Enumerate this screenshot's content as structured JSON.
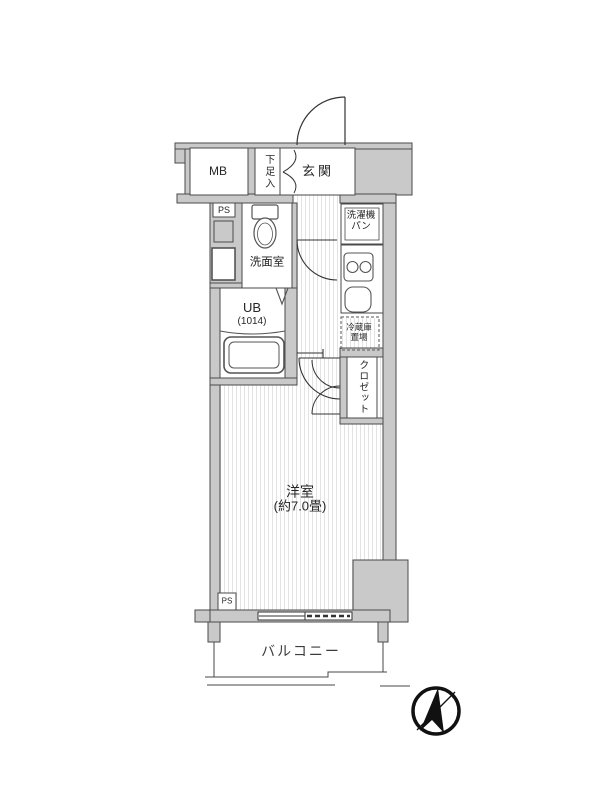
{
  "plan": {
    "type": "apartment-floor-plan",
    "rooms": {
      "meter_box": {
        "label": "MB"
      },
      "shoe_storage": {
        "label": "下足入"
      },
      "entrance": {
        "label": "玄関"
      },
      "pipe_space_upper": {
        "label": "PS"
      },
      "washroom": {
        "label": "洗面室"
      },
      "washing_machine_pan": {
        "line1": "洗濯機",
        "line2": "パン"
      },
      "unit_bath": {
        "label": "UB",
        "size": "(1014)"
      },
      "refrigerator_space": {
        "line1": "冷蔵庫",
        "line2": "置場"
      },
      "closet": {
        "label": "クロゼット"
      },
      "western_room": {
        "label": "洋室",
        "size": "(約7.0畳)"
      },
      "pipe_space_lower": {
        "label": "PS"
      },
      "balcony": {
        "label": "バルコニー"
      }
    },
    "icons": {
      "compass": "north-compass"
    },
    "colors": {
      "wall_fill": "#c9c9c9",
      "outline": "#4a4a4a",
      "floor_stripe": "#e3e3e3",
      "text": "#262626"
    }
  }
}
